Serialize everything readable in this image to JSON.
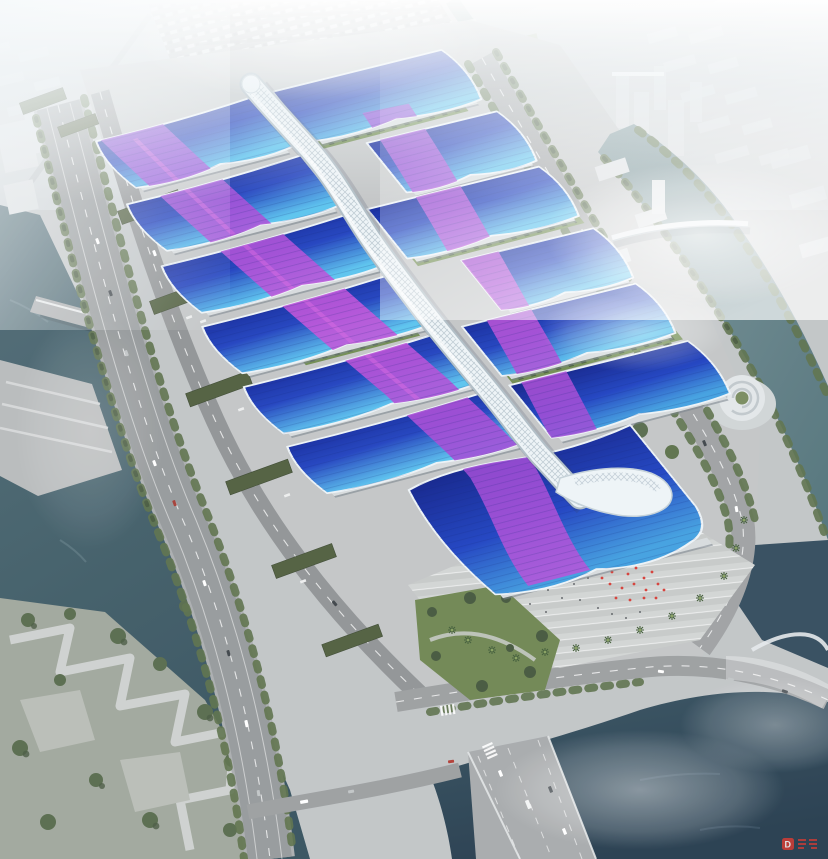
{
  "meta": {
    "title": "Aerial rendering — riverside exhibition & convention center complex",
    "canvas": {
      "width": 828,
      "height": 859
    }
  },
  "watermark": {
    "logo_letter": "D",
    "text": "读特",
    "color": "#cf3a30"
  },
  "palette": {
    "roofDeep": "#10269b",
    "roofBlue": "#1d3fbe",
    "roofCyan": "#58c2ee",
    "ribbonViolet": "#8a46d6",
    "ribbonMagenta": "#c44fd9",
    "spineWhite": "#eef4f7",
    "waterRiver": "#44606c",
    "waterCanal": "#66858c",
    "waterNavy": "#2c4255",
    "pavement": "#c2c5c6",
    "plaza": "#ced1d0",
    "asphalt": "#94989a",
    "treeGreen": "#5a6f48",
    "treeDark": "#41523a",
    "courtyardGreen": "#6f8b4f",
    "shedRoof": "#4d5c3c",
    "cityBlock": "#d9dee1",
    "redAccent": "#d43c35",
    "hazeWhite": "#f4f8fa"
  },
  "scene": {
    "regions": [
      {
        "name": "hazy-city-skyline",
        "note": "faded white city grid across the top, fog"
      },
      {
        "name": "west-river",
        "note": "teal river along left edge with terraced banks, bridge, waterfront park"
      },
      {
        "name": "east-canal",
        "note": "canal with tree-lined banks, pedestrian bridge, spiral landmark building"
      },
      {
        "name": "south-water",
        "note": "dark navy water body at bottom right crossed by road bridges"
      },
      {
        "name": "highway",
        "note": "multi-lane arterial road running along the west side"
      },
      {
        "name": "exhibition-complex",
        "note": "two columns of wave-roofed halls, blue gradient roofs with purple ribbon graphics"
      },
      {
        "name": "central-spine",
        "note": "white serpentine concourse tube linking all halls, ends in a swoosh"
      },
      {
        "name": "south-entrance-plaza",
        "note": "striped forecourt with palm trees, visitors and red ceremony decorations"
      },
      {
        "name": "parking-lot-north",
        "note": "large parking apron with vehicle rows"
      }
    ]
  }
}
